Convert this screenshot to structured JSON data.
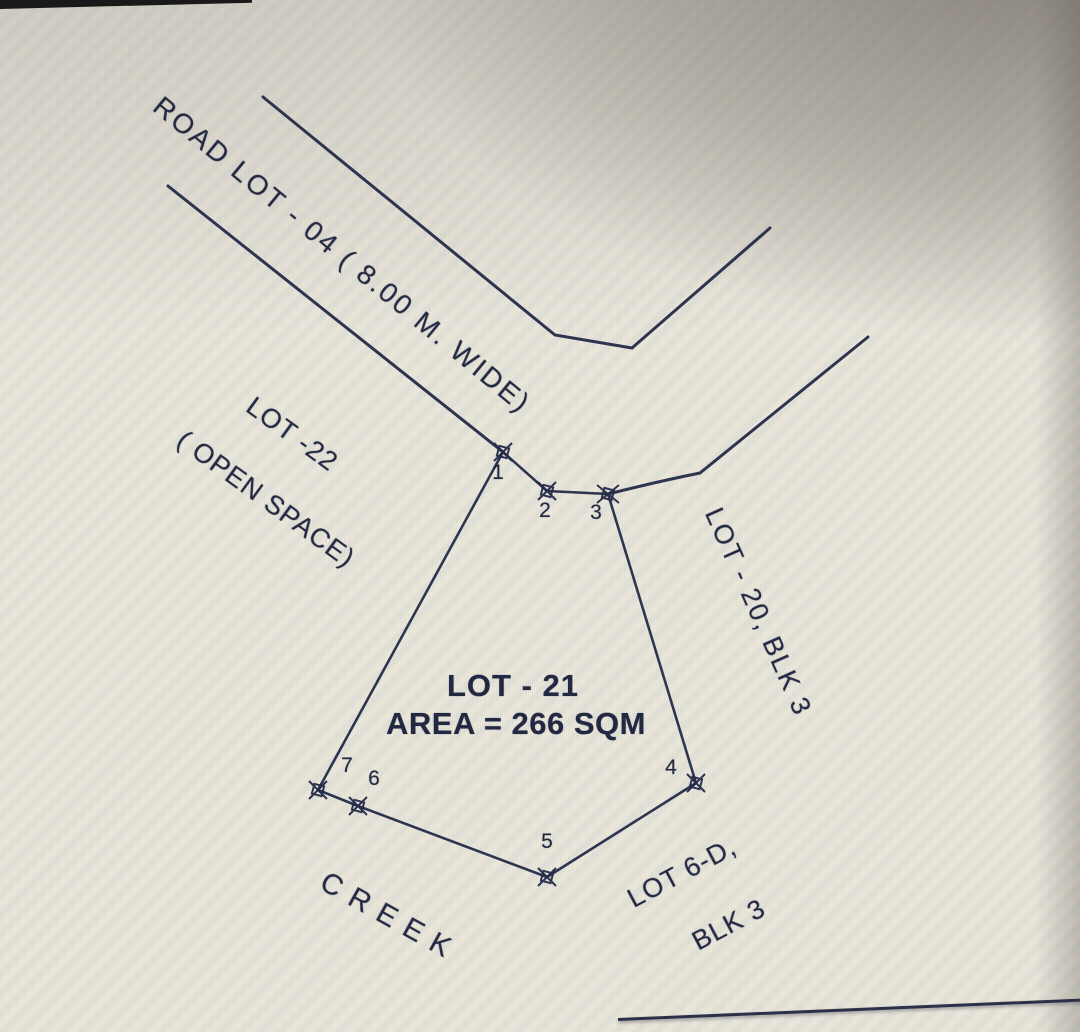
{
  "document": {
    "type": "lot-survey-sketch-photo",
    "subject_lot": {
      "name": "LOT - 21",
      "area_label": "AREA = 266 SQM",
      "area_sqm": 266
    }
  },
  "labels": {
    "road_lot": "ROAD LOT - 04 ( 8.00 M. WIDE)",
    "lot22_line1": "LOT -22",
    "lot22_line2": "( OPEN SPACE)",
    "lot21_title": "LOT - 21",
    "lot21_area": "AREA = 266 SQM",
    "lot20": "LOT - 20, BLK 3",
    "lot6d_line1": "LOT 6-D,",
    "lot6d_line2": "BLK 3",
    "creek": "CREEK"
  },
  "corner_points": [
    {
      "id": "1"
    },
    {
      "id": "2"
    },
    {
      "id": "3"
    },
    {
      "id": "4"
    },
    {
      "id": "5"
    },
    {
      "id": "6"
    },
    {
      "id": "7"
    }
  ],
  "adjacent_features": [
    "ROAD LOT - 04 ( 8.00 M. WIDE)",
    "LOT -22 ( OPEN SPACE)",
    "LOT - 20, BLK 3",
    "LOT 6-D, BLK 3",
    "CREEK"
  ],
  "colors": {
    "ink": "#232a47",
    "paper": "#e9e5da",
    "shadow": "#5c554d",
    "edge_strip": "#191919"
  }
}
